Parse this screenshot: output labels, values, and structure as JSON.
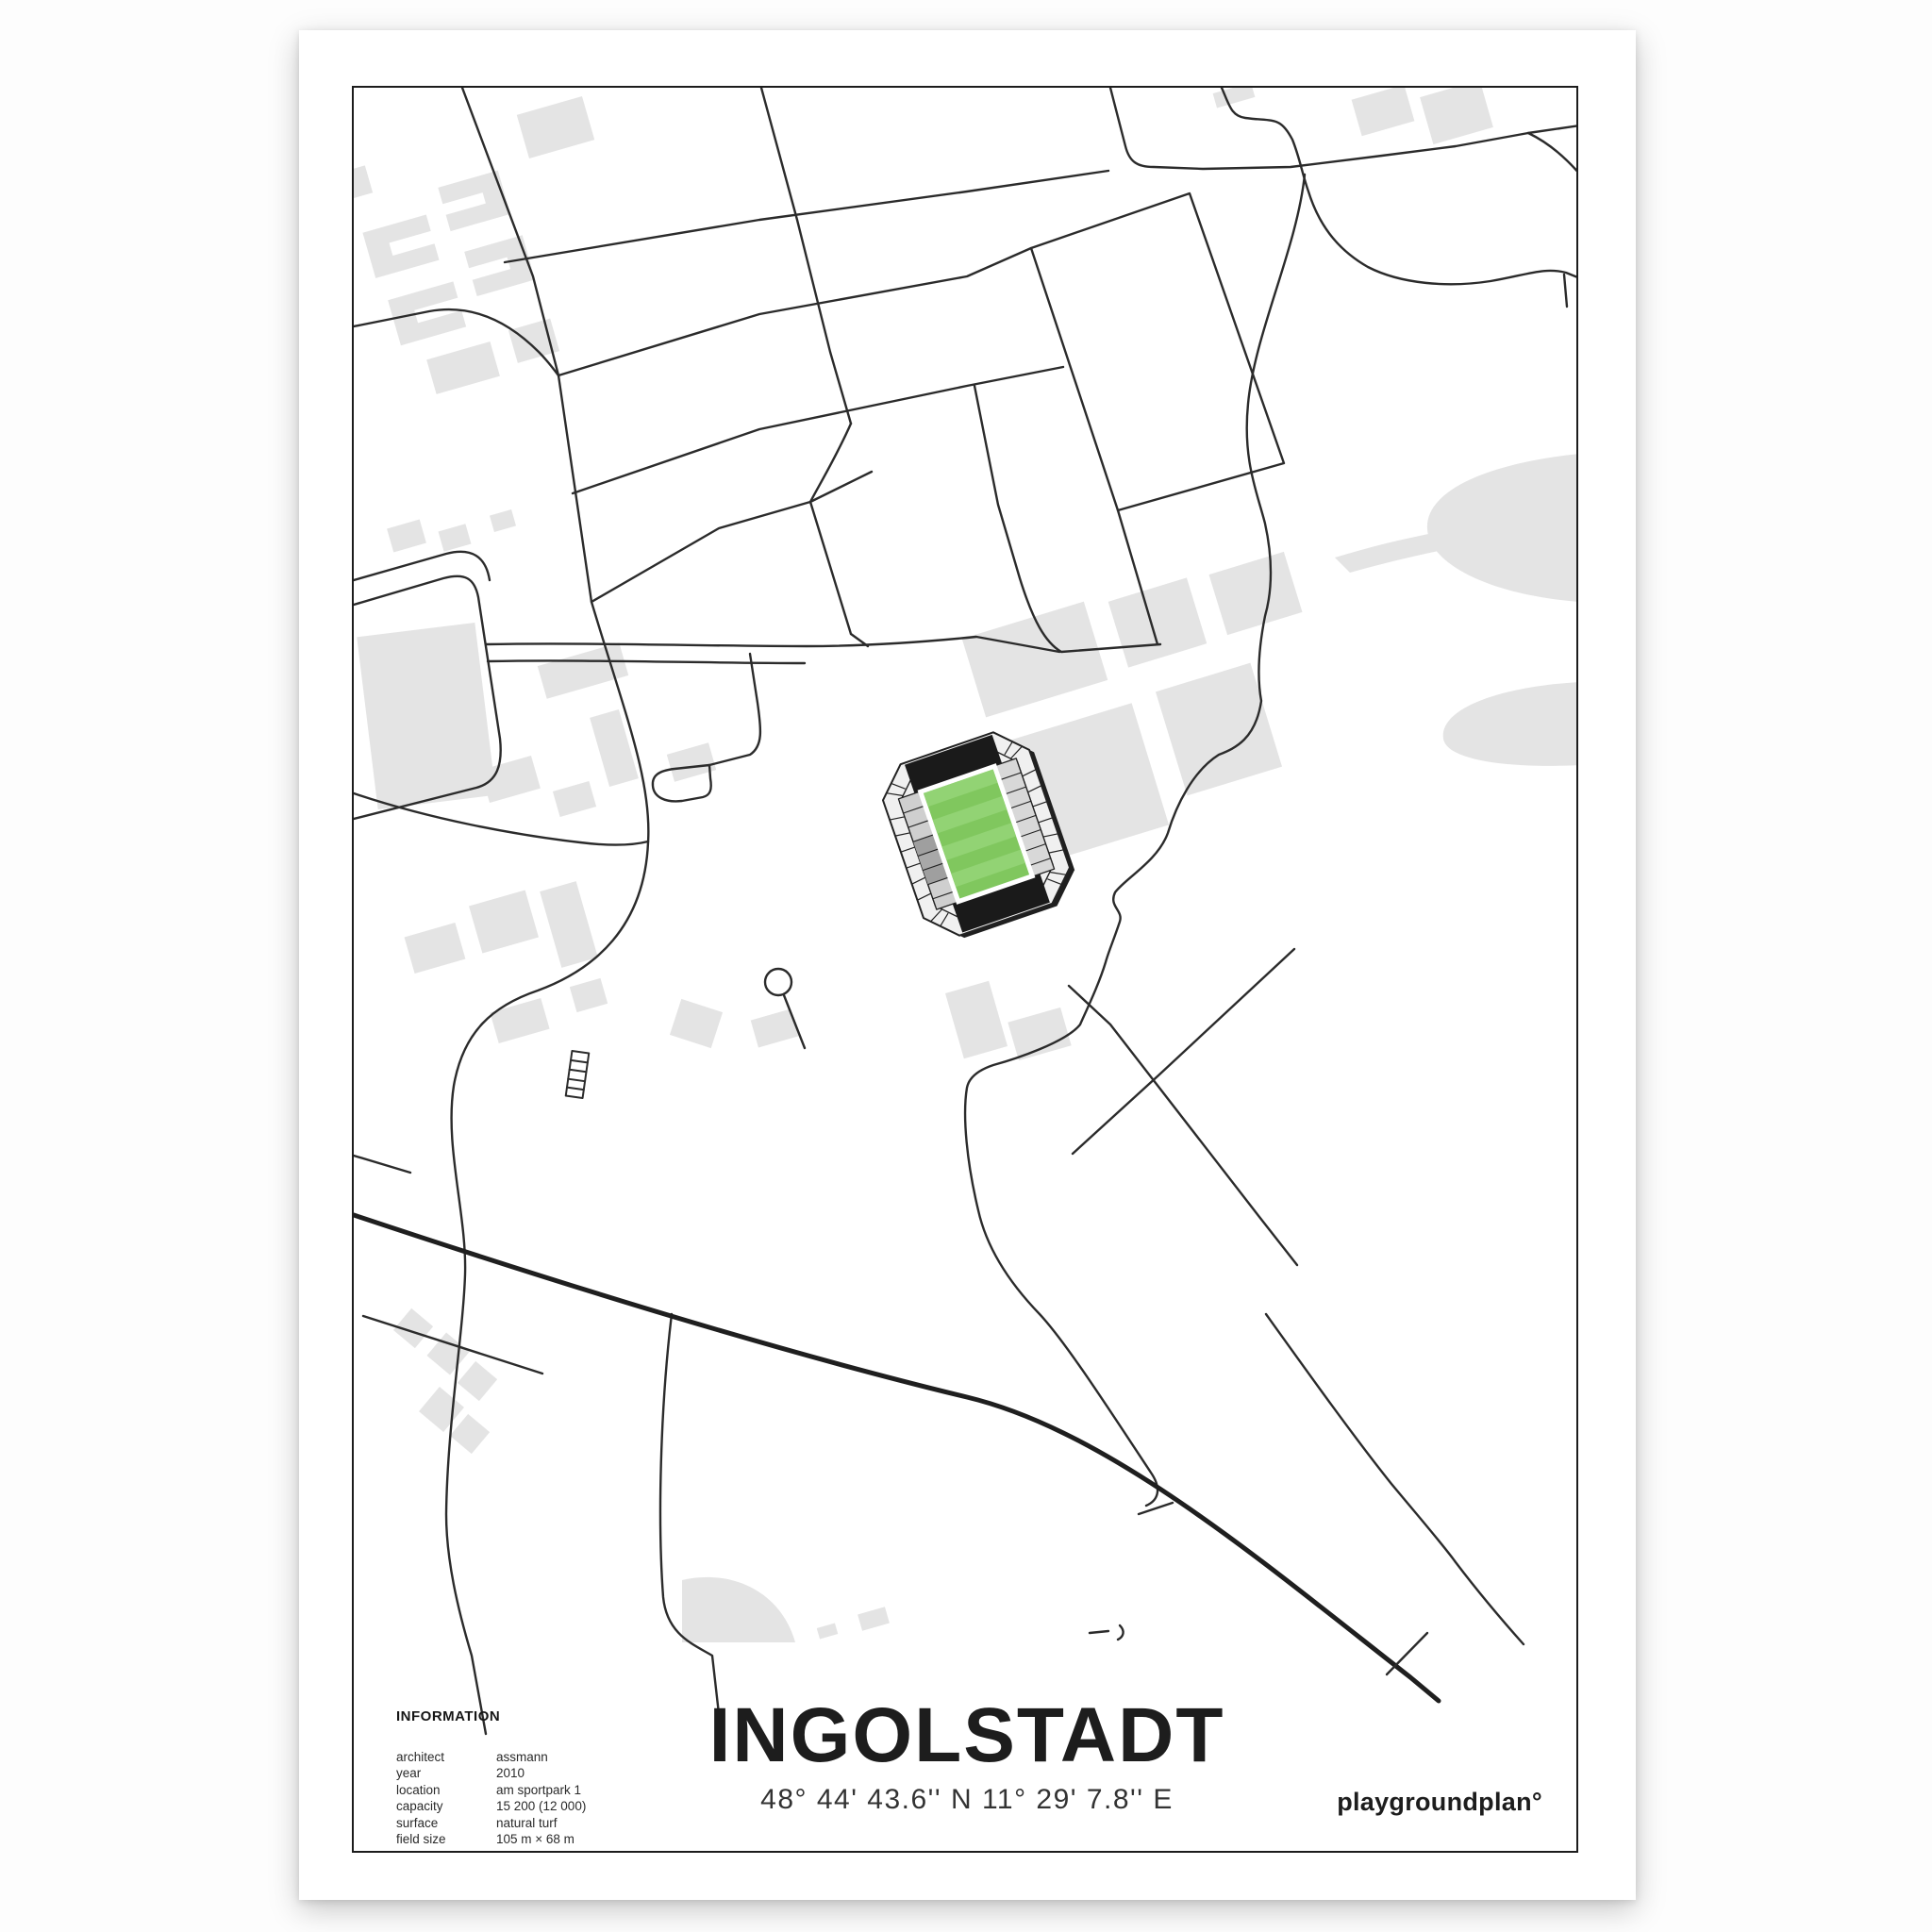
{
  "poster": {
    "title": "INGOLSTADT",
    "coordinates": "48° 44' 43.6'' N  11° 29' 7.8'' E",
    "brand": "playgroundplan°",
    "info": {
      "heading": "INFORMATION",
      "rows": [
        {
          "label": "architect",
          "value": "assmann"
        },
        {
          "label": "year",
          "value": "2010"
        },
        {
          "label": "location",
          "value": "am sportpark 1"
        },
        {
          "label": "capacity",
          "value": "15 200 (12 000)"
        },
        {
          "label": "surface",
          "value": "natural turf"
        },
        {
          "label": "field size",
          "value": "105 m × 68 m"
        }
      ]
    },
    "map": {
      "style": "minimal-line-map",
      "colors": {
        "background": "#ffffff",
        "road": "#2b2b2b",
        "building": "#e4e4e4",
        "frame": "#1c1c1c",
        "pitch_green": "#80c75e",
        "pitch_stripe": "#92d374",
        "end_stand_black": "#1a1a1a",
        "side_stand_gray": "#cfcfcf",
        "ring_gray": "#f0f0f0"
      },
      "stadium": {
        "name": "audi sportpark",
        "pitch": "green striped",
        "orientation_deg": -19
      }
    }
  }
}
